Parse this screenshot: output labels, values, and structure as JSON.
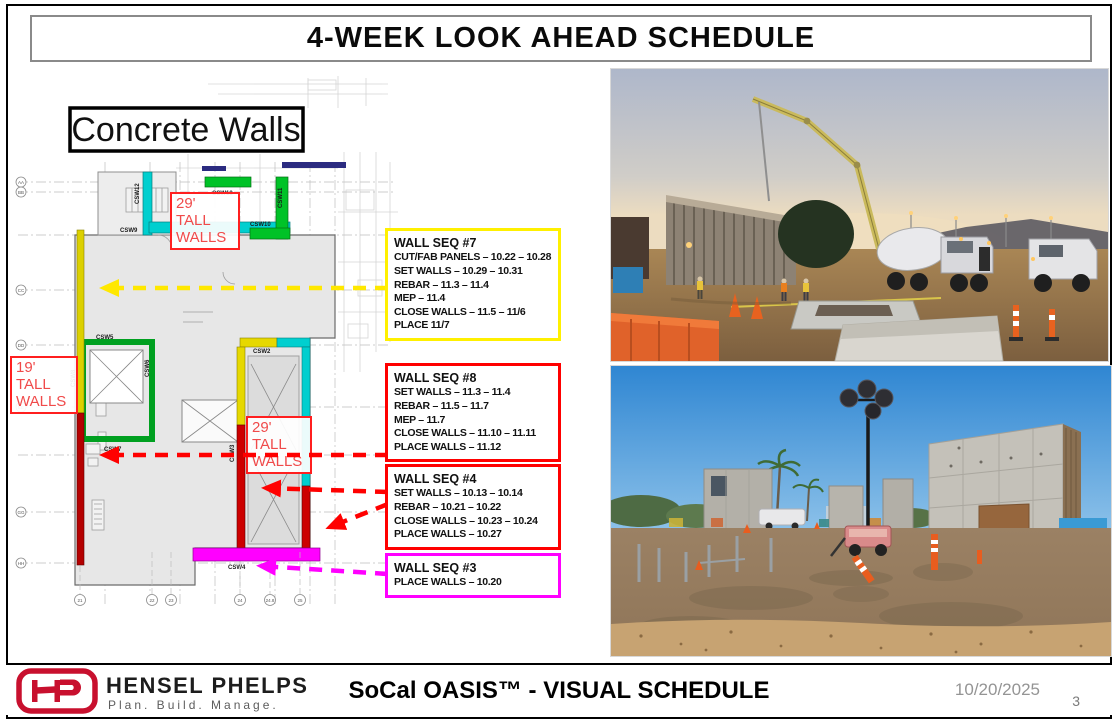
{
  "slide": {
    "title": "4-WEEK LOOK AHEAD SCHEDULE"
  },
  "plan": {
    "title": "Concrete Walls",
    "labels": {
      "tall29_upper": "29' TALL WALLS",
      "tall19": "19' TALL WALLS",
      "tall29_lower": "29' TALL WALLS"
    },
    "tags": {
      "csw2": "CSW2",
      "csw3": "CSW3",
      "csw4": "CSW4",
      "csw5": "CSW5",
      "csw6": "CSW6",
      "csw7": "CSW7",
      "csw8": "CSW8",
      "csw9": "CSW9",
      "csw10": "CSW10",
      "csw11": "CSW11",
      "csw12": "CSW12",
      "csw13": "CSW13"
    },
    "grid_bottom": [
      "21",
      "22",
      "23",
      "24",
      "24.8",
      "25"
    ],
    "grid_left": [
      "AA",
      "BB",
      "CC",
      "DD",
      "EE",
      "GG",
      "HH"
    ],
    "wall_colors": {
      "green": "#00B43C",
      "cyan": "#00CFCF",
      "yellow": "#E0D400",
      "red": "#BE0000",
      "magenta": "#FF00FF"
    }
  },
  "callouts": [
    {
      "title": "WALL SEQ #7",
      "border": "#FFF000",
      "lines": [
        "CUT/FAB PANELS – 10.22 – 10.28",
        "SET WALLS – 10.29 – 10.31",
        "REBAR – 11.3 – 11.4",
        "MEP – 11.4",
        "CLOSE WALLS – 11.5 – 11/6",
        "PLACE 11/7"
      ]
    },
    {
      "title": "WALL SEQ #8",
      "border": "#FF0000",
      "lines": [
        "SET WALLS – 11.3 – 11.4",
        "REBAR – 11.5 – 11.7",
        "MEP – 11.7",
        "CLOSE WALLS – 11.10 – 11.11",
        "PLACE WALLS – 11.12"
      ]
    },
    {
      "title": "WALL SEQ #4",
      "border": "#FF0000",
      "lines": [
        "SET WALLS – 10.13 – 10.14",
        "REBAR – 10.21 – 10.22",
        "CLOSE WALLS – 10.23 – 10.24",
        "PLACE WALLS – 10.27"
      ]
    },
    {
      "title": "WALL SEQ #3",
      "border": "#FF00FF",
      "lines": [
        "PLACE WALLS – 10.20"
      ]
    }
  ],
  "footer": {
    "company": "HENSEL PHELPS",
    "tagline": "Plan. Build. Manage.",
    "center_title": "SoCal OASIS™ - VISUAL SCHEDULE",
    "date": "10/20/2025",
    "page": "3",
    "brand_red": "#C8102E"
  }
}
